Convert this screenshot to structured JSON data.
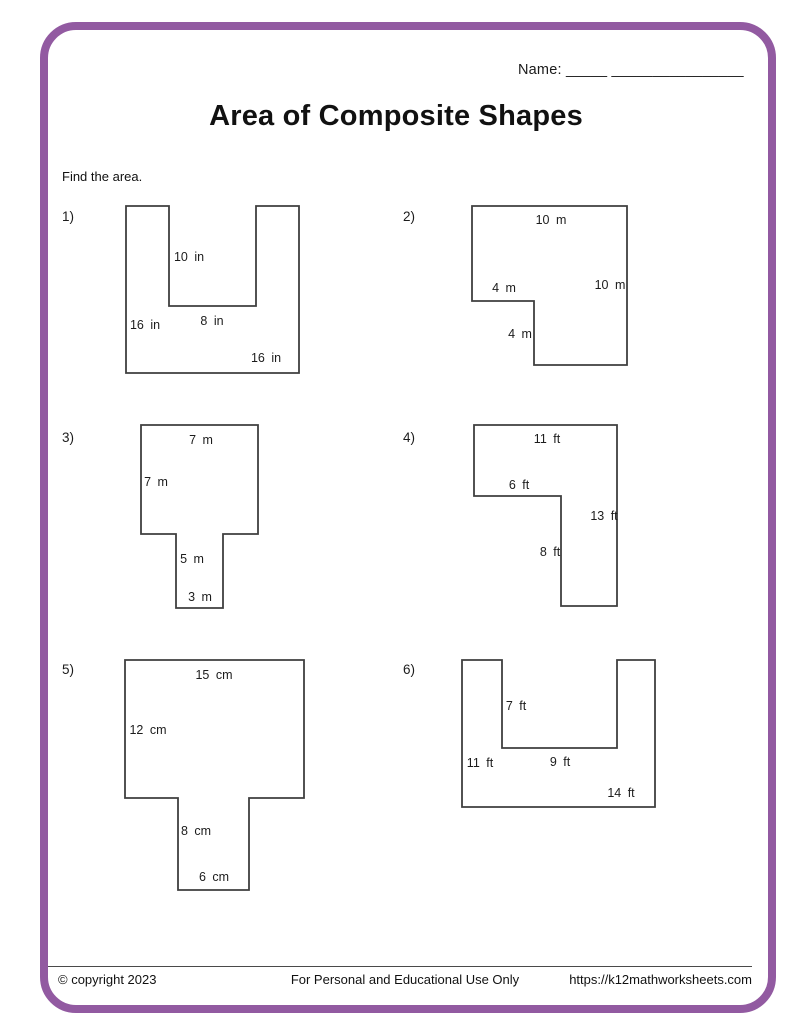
{
  "page": {
    "accent_color": "#925AA1",
    "name_label": "Name:",
    "name_line": "_____ ________________",
    "title": "Area of Composite Shapes",
    "instruction": "Find the area."
  },
  "problems": [
    {
      "number": "1)",
      "num_x": 62,
      "num_y": 221,
      "points": "126,206 169,206 169,306 256,306 256,206 299,206 299,373 126,373",
      "labels": [
        {
          "text": "10 in",
          "x": 189,
          "y": 261
        },
        {
          "text": "8 in",
          "x": 212,
          "y": 325
        },
        {
          "text": "16 in",
          "x": 145,
          "y": 329
        },
        {
          "text": "16 in",
          "x": 266,
          "y": 362
        }
      ]
    },
    {
      "number": "2)",
      "num_x": 403,
      "num_y": 221,
      "points": "472,206 627,206 627,365 534,365 534,301 472,301",
      "labels": [
        {
          "text": "10 m",
          "x": 551,
          "y": 224
        },
        {
          "text": "4 m",
          "x": 504,
          "y": 292
        },
        {
          "text": "10 m",
          "x": 610,
          "y": 289
        },
        {
          "text": "4 m",
          "x": 520,
          "y": 338
        }
      ]
    },
    {
      "number": "3)",
      "num_x": 62,
      "num_y": 442,
      "points": "141,425 258,425 258,534 223,534 223,608 176,608 176,534 141,534",
      "labels": [
        {
          "text": "7 m",
          "x": 201,
          "y": 444
        },
        {
          "text": "7 m",
          "x": 156,
          "y": 486
        },
        {
          "text": "5 m",
          "x": 192,
          "y": 563
        },
        {
          "text": "3 m",
          "x": 200,
          "y": 601
        }
      ]
    },
    {
      "number": "4)",
      "num_x": 403,
      "num_y": 442,
      "points": "474,425 617,425 617,606 561,606 561,496 474,496",
      "labels": [
        {
          "text": "11 ft",
          "x": 547,
          "y": 443
        },
        {
          "text": "6 ft",
          "x": 519,
          "y": 489
        },
        {
          "text": "13 ft",
          "x": 604,
          "y": 520
        },
        {
          "text": "8 ft",
          "x": 550,
          "y": 556
        }
      ]
    },
    {
      "number": "5)",
      "num_x": 62,
      "num_y": 674,
      "points": "125,660 304,660 304,798 249,798 249,890 178,890 178,798 125,798",
      "labels": [
        {
          "text": "15 cm",
          "x": 214,
          "y": 679
        },
        {
          "text": "12 cm",
          "x": 148,
          "y": 734
        },
        {
          "text": "8 cm",
          "x": 196,
          "y": 835
        },
        {
          "text": "6 cm",
          "x": 214,
          "y": 881
        }
      ]
    },
    {
      "number": "6)",
      "num_x": 403,
      "num_y": 674,
      "points": "462,660 502,660 502,748 617,748 617,660 655,660 655,807 462,807",
      "labels": [
        {
          "text": "7 ft",
          "x": 516,
          "y": 710
        },
        {
          "text": "11 ft",
          "x": 480,
          "y": 767
        },
        {
          "text": "9 ft",
          "x": 560,
          "y": 766
        },
        {
          "text": "14 ft",
          "x": 621,
          "y": 797
        }
      ]
    }
  ],
  "footer": {
    "copyright": "© copyright 2023",
    "usage": "For Personal and Educational Use Only",
    "url": "https://k12mathworksheets.com"
  }
}
